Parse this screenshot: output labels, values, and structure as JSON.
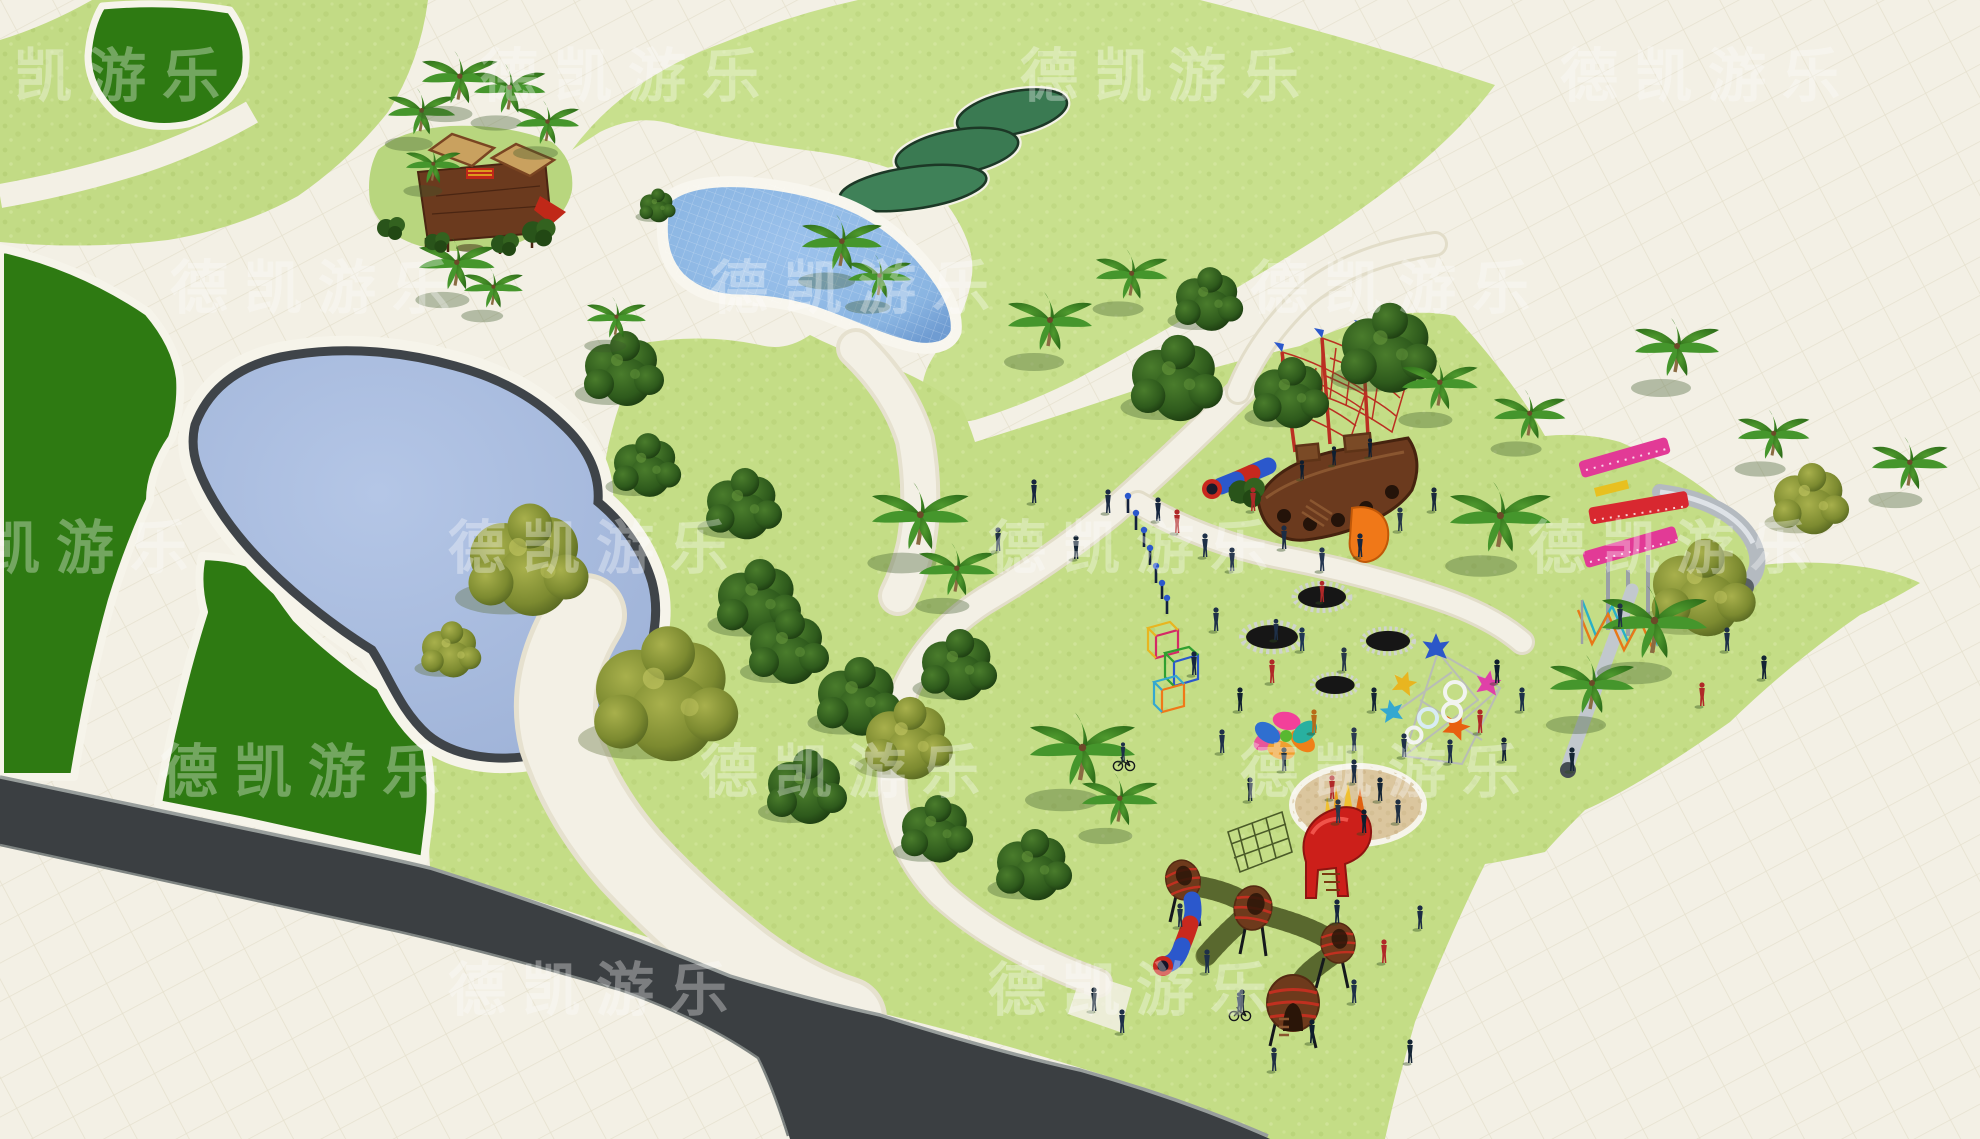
{
  "scene": {
    "kind": "3d-aerial-park-playground-render",
    "width": 1980,
    "height": 1139
  },
  "watermark": {
    "text": "德凯游乐",
    "color": "#ffffff",
    "opacity": 0.33
  },
  "palette": {
    "paving": "#f3f0e5",
    "tile_line": "#e6e1cf",
    "grass_light": "#c6de88",
    "grass_speckle": "#8fae4a",
    "dark_green_lawn": "#2e7a12",
    "pond_water": "#a9bcdf",
    "pond_rim": "#3f4449",
    "pool_water": "#8ab5e2",
    "bean_pond": "#3a7a52",
    "road_asphalt": "#3b3f42",
    "road_curb": "#989e9c",
    "sand": "#dbc69e",
    "wood_dark": "#5e3317",
    "wood_mid": "#7a4a26",
    "thatch": "#c9a15f",
    "equip_red": "#c42a1e",
    "equip_blue": "#2b58cc",
    "equip_orange": "#f07818",
    "equip_pink": "#e23a96",
    "equip_metal": "#bcc2c8",
    "rope_red": "#bb2f22",
    "rope_green": "#75853f",
    "trampoline": "#161616"
  },
  "features": [
    "dark-green-lawn-areas",
    "grass-hills",
    "upper-swimming-pool",
    "lower-pond",
    "bean-shaped-green-ponds",
    "asphalt-road",
    "paved-walkways",
    "wooden-adventure-playground",
    "pirate-ship-rope-playground",
    "tube-slide",
    "pink-spiral-slide-tower",
    "trampolines",
    "star-rope-climber",
    "flower-sculpture",
    "sand-pit",
    "red-slide-sculpture",
    "barrel-rope-tunnel-playground",
    "cube-climbing-frames",
    "palm-trees",
    "deciduous-trees",
    "visitor-figures",
    "watermarks"
  ]
}
